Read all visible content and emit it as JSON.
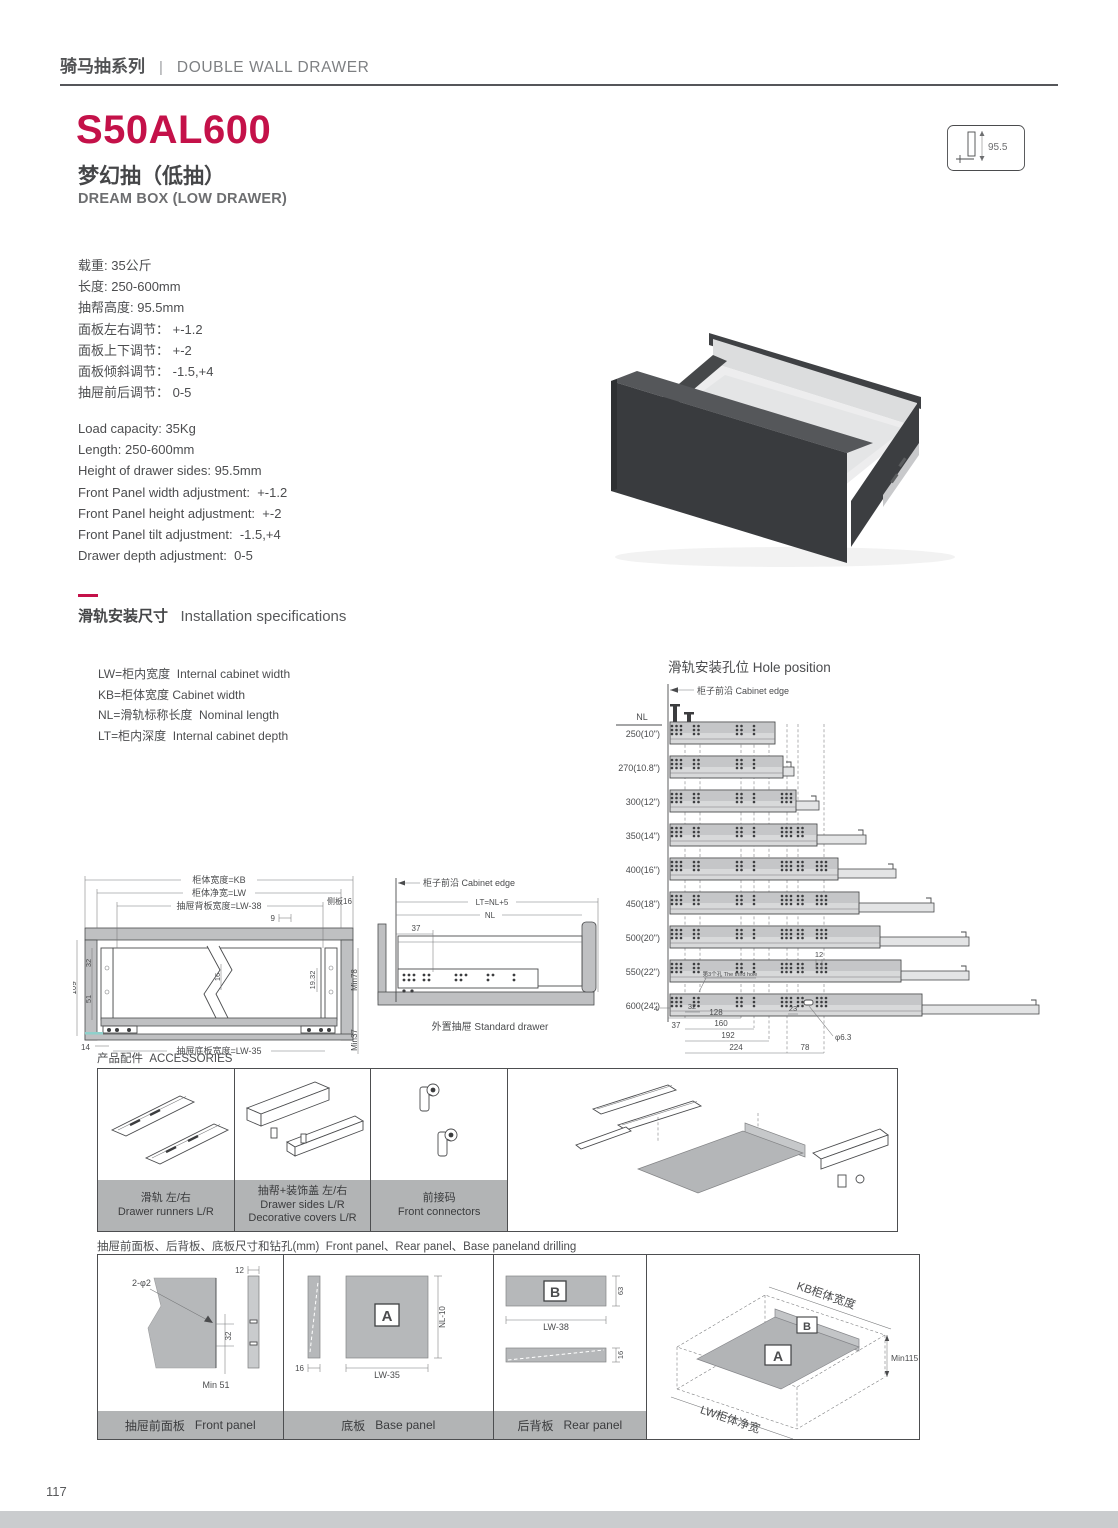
{
  "colors": {
    "accent": "#c41149",
    "caption_bar": "#b2b4b5"
  },
  "header": {
    "series_cn": "骑马抽系列",
    "series_sep": "|",
    "series_en": "DOUBLE WALL DRAWER"
  },
  "product": {
    "model": "S50AL600",
    "name_cn": "梦幻抽（低抽）",
    "name_en": "DREAM BOX (LOW DRAWER)",
    "height_badge": "95.5"
  },
  "specs_cn": [
    "载重: 35公斤",
    "长度: 250-600mm",
    "抽帮高度: 95.5mm",
    "面板左右调节： +-1.2",
    "面板上下调节： +-2",
    "面板倾斜调节： -1.5,+4",
    "抽屉前后调节： 0-5"
  ],
  "specs_en": [
    "Load capacity: 35Kg",
    "Length: 250-600mm",
    "Height of drawer sides: 95.5mm",
    "Front Panel width adjustment:  +-1.2",
    "Front Panel height adjustment:  +-2",
    "Front Panel tilt adjustment:  -1.5,+4",
    "Drawer depth adjustment:  0-5"
  ],
  "install": {
    "title_cn": "滑轨安装尺寸",
    "title_en": "Installation specifications",
    "legend": [
      "LW=柜内宽度  Internal cabinet width",
      "KB=柜体宽度 Cabinet width",
      "NL=滑轨标称长度  Nominal length",
      "LT=柜内深度  Internal cabinet depth"
    ]
  },
  "hole_position": {
    "title": "滑轨安装孔位 Hole position",
    "cabinet_edge": "柜子前沿 Cabinet edge",
    "nl_header": "NL",
    "rows": [
      "250(10\")",
      "270(10.8\")",
      "300(12\")",
      "350(14\")",
      "400(16\")",
      "450(18\")",
      "500(20\")",
      "550(22\")",
      "600(24\")"
    ],
    "nl_values": [
      250,
      270,
      300,
      350,
      400,
      450,
      500,
      550,
      600
    ],
    "note": "第3个孔 The third hole",
    "dims": {
      "d4": "4",
      "d37": "37",
      "d32": "32",
      "d128": "128",
      "d160": "160",
      "d192": "192",
      "d224": "224",
      "d23": "23",
      "d12": "12",
      "d78": "78",
      "hole_dia": "φ6.3"
    }
  },
  "cross_section": {
    "kb": "柜体宽度=KB",
    "lw": "柜体净宽=LW",
    "back_width": "抽屉背板宽度=LW-38",
    "side_panel": "侧板16",
    "d9": "9",
    "d16": "16",
    "d19_32": "19.32",
    "min78": "Min78",
    "d109": "109",
    "d32": "32",
    "d51": "51",
    "d14": "14",
    "base_width": "抽屉底板宽度=LW-35",
    "min37": "Min37"
  },
  "side_view": {
    "cabinet_edge": "柜子前沿 Cabinet edge",
    "lt": "LT=NL+5",
    "nl": "NL",
    "d37": "37",
    "caption": "外置抽屉 Standard drawer"
  },
  "accessories": {
    "title_cn": "产品配件",
    "title_en": "ACCESSORIES",
    "items": [
      {
        "cn": "滑轨 左/右",
        "en": "Drawer runners  L/R"
      },
      {
        "cn": "抽帮+装饰盖 左/右",
        "en": "Drawer sides  L/R",
        "en2": "Decorative covers  L/R"
      },
      {
        "cn": "前接码",
        "en": "Front connectors"
      }
    ]
  },
  "panels": {
    "title_cn": "抽屉前面板、后背板、底板尺寸和钻孔(mm)",
    "title_en": "Front panel、Rear panel、Base paneland drilling",
    "front": {
      "cn": "抽屉前面板",
      "en": "Front panel",
      "hole": "2-φ2",
      "d12": "12",
      "d32": "32",
      "min": "Min 51"
    },
    "base": {
      "cn": "底板",
      "en": "Base panel",
      "label": "A",
      "d16": "16",
      "w": "LW-35",
      "d": "NL-10"
    },
    "rear": {
      "cn": "后背板",
      "en": "Rear panel",
      "label": "B",
      "d63": "63",
      "w": "LW-38",
      "d16": "16"
    },
    "iso": {
      "kb": "KB柜体宽度",
      "lw": "LW柜体净宽",
      "min": "Min115",
      "a": "A",
      "b": "B"
    }
  },
  "footer": {
    "page": "117"
  }
}
